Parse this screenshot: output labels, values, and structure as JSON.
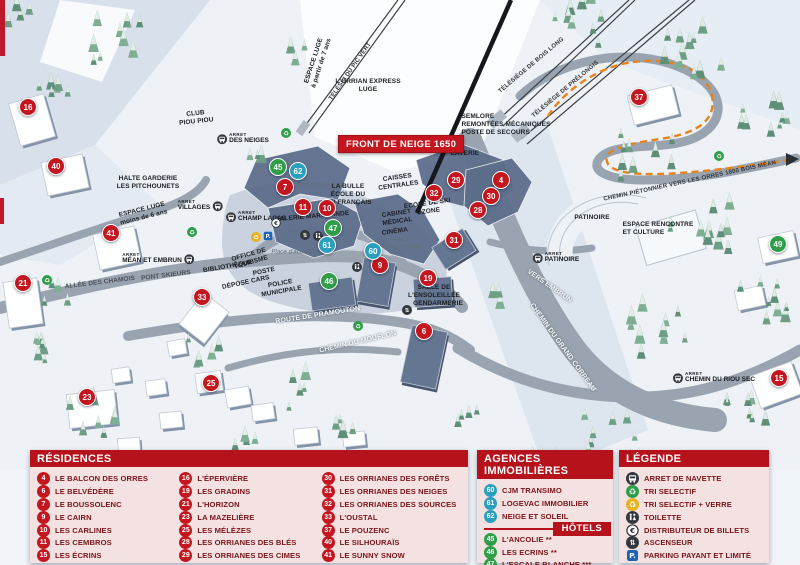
{
  "banner": "FRONT DE NEIGE 1650",
  "arret_prefix": "ARRET",
  "colors": {
    "marker_red": "#c4161f",
    "marker_green": "#2f9e49",
    "marker_blue": "#2b9fbe",
    "header_red": "#b5121b",
    "panel_bg": "#f4e2e2",
    "label_maroon": "#7a1419",
    "parking_blue": "#1f63b5",
    "recycle_green": "#2f9e49",
    "recycle_yellow": "#e9b320",
    "path_orange": "#e8831c"
  },
  "map": {
    "markers": [
      {
        "n": "16",
        "x": 28,
        "y": 107,
        "c": "red"
      },
      {
        "n": "40",
        "x": 56,
        "y": 166,
        "c": "red"
      },
      {
        "n": "41",
        "x": 111,
        "y": 233,
        "c": "red"
      },
      {
        "n": "21",
        "x": 23,
        "y": 283,
        "c": "red"
      },
      {
        "n": "33",
        "x": 202,
        "y": 297,
        "c": "red"
      },
      {
        "n": "23",
        "x": 87,
        "y": 397,
        "c": "red"
      },
      {
        "n": "25",
        "x": 211,
        "y": 383,
        "c": "red"
      },
      {
        "n": "7",
        "x": 285,
        "y": 187,
        "c": "red"
      },
      {
        "n": "11",
        "x": 303,
        "y": 207,
        "c": "red"
      },
      {
        "n": "10",
        "x": 327,
        "y": 208,
        "c": "red"
      },
      {
        "n": "9",
        "x": 380,
        "y": 265,
        "c": "red"
      },
      {
        "n": "19",
        "x": 428,
        "y": 278,
        "c": "red"
      },
      {
        "n": "6",
        "x": 424,
        "y": 331,
        "c": "red"
      },
      {
        "n": "29",
        "x": 456,
        "y": 180,
        "c": "red"
      },
      {
        "n": "32",
        "x": 434,
        "y": 193,
        "c": "red"
      },
      {
        "n": "4",
        "x": 501,
        "y": 180,
        "c": "red"
      },
      {
        "n": "30",
        "x": 491,
        "y": 196,
        "c": "red"
      },
      {
        "n": "28",
        "x": 478,
        "y": 210,
        "c": "red"
      },
      {
        "n": "31",
        "x": 454,
        "y": 240,
        "c": "red"
      },
      {
        "n": "37",
        "x": 639,
        "y": 97,
        "c": "red"
      },
      {
        "n": "15",
        "x": 779,
        "y": 378,
        "c": "red"
      },
      {
        "n": "45",
        "x": 278,
        "y": 167,
        "c": "green"
      },
      {
        "n": "47",
        "x": 333,
        "y": 228,
        "c": "green"
      },
      {
        "n": "46",
        "x": 329,
        "y": 281,
        "c": "green"
      },
      {
        "n": "49",
        "x": 778,
        "y": 244,
        "c": "green"
      },
      {
        "n": "62",
        "x": 298,
        "y": 171,
        "c": "blue"
      },
      {
        "n": "61",
        "x": 327,
        "y": 245,
        "c": "blue"
      },
      {
        "n": "60",
        "x": 373,
        "y": 251,
        "c": "blue"
      }
    ],
    "labels": [
      {
        "t": "ESPACE LUGE\nà partir de 7 ans",
        "x": 318,
        "y": 62,
        "r": -72,
        "s": "place"
      },
      {
        "t": "TÉLÉSKI DU PIC VERT",
        "x": 351,
        "y": 72,
        "r": -55,
        "s": "lift"
      },
      {
        "t": "TÉLÉSIÈGE DE BOIS LONG",
        "x": 532,
        "y": 66,
        "r": -40,
        "s": "lift"
      },
      {
        "t": "TÉLÉSIÈGE DE PRÉLONGIS",
        "x": 566,
        "y": 90,
        "r": -40,
        "s": "lift"
      },
      {
        "t": "L'ORRIAN EXPRESS\nLUGE",
        "x": 368,
        "y": 86,
        "r": 0,
        "s": "place"
      },
      {
        "t": "SEMLORE\nREMONTÉES MÉCANIQUES\nPOSTE DE SECOURS",
        "x": 506,
        "y": 125,
        "r": 0,
        "s": "place left"
      },
      {
        "t": "CHEMIN PIÉTONNIER\nVERS LES ORRES 1800\nBOIS MÉAN",
        "x": 690,
        "y": 182,
        "r": -12,
        "s": "lift left"
      },
      {
        "t": "CLUB\nPIOU PIOU",
        "x": 196,
        "y": 118,
        "r": -6,
        "s": "place"
      },
      {
        "t": "HALTE GARDERIE\nLES PITCHOUNETS",
        "x": 148,
        "y": 183,
        "r": 0,
        "s": "place"
      },
      {
        "t": "ESPACE LUGE\nmoins de 6 ans",
        "x": 143,
        "y": 214,
        "r": -14,
        "s": "place"
      },
      {
        "t": "OFFICE DE\nTOURISME",
        "x": 250,
        "y": 259,
        "r": -16,
        "s": "place"
      },
      {
        "t": "BIBLIOTHÈQUE",
        "x": 228,
        "y": 267,
        "r": -10,
        "s": "place"
      },
      {
        "t": "POSTE",
        "x": 264,
        "y": 272,
        "r": -12,
        "s": "place"
      },
      {
        "t": "DÉPOSE CARS",
        "x": 246,
        "y": 283,
        "r": -12,
        "s": "place"
      },
      {
        "t": "POLICE\nMUNICIPALE",
        "x": 281,
        "y": 288,
        "r": -10,
        "s": "place"
      },
      {
        "t": "ALLÉE DES CHAMOIS",
        "x": 100,
        "y": 283,
        "r": -7,
        "s": "road-dark"
      },
      {
        "t": "PONT SKIEURS",
        "x": 166,
        "y": 276,
        "r": -7,
        "s": "road-dark"
      },
      {
        "t": "Place d'accueil",
        "x": 292,
        "y": 253,
        "r": 0,
        "s": "it"
      },
      {
        "t": "Place du festival",
        "x": 320,
        "y": 186,
        "r": 0,
        "s": "it"
      },
      {
        "t": "Place\nÉmile Hodoul",
        "x": 402,
        "y": 245,
        "r": 0,
        "s": "it"
      },
      {
        "t": "LA BULLE\nÉCOLE DU\nSKI FRANÇAIS",
        "x": 348,
        "y": 195,
        "r": 0,
        "s": "place"
      },
      {
        "t": "GALERIE MARCHANDE",
        "x": 312,
        "y": 217,
        "r": -5,
        "s": "place"
      },
      {
        "t": "CAISSES\nCENTRALES",
        "x": 398,
        "y": 182,
        "r": -8,
        "s": "place"
      },
      {
        "t": "CABINET\nMÉDICAL",
        "x": 397,
        "y": 218,
        "r": -8,
        "s": "place"
      },
      {
        "t": "CINÉMA",
        "x": 395,
        "y": 232,
        "r": -8,
        "s": "place"
      },
      {
        "t": "ÉCOLE DE SKI\nOZONE",
        "x": 428,
        "y": 208,
        "r": -8,
        "s": "place"
      },
      {
        "t": "LAVERIE",
        "x": 465,
        "y": 154,
        "r": 0,
        "s": "place"
      },
      {
        "t": "SALLE DE\nL'ENSOLEILLÉE",
        "x": 434,
        "y": 292,
        "r": 0,
        "s": "place"
      },
      {
        "t": "GENDARMERIE",
        "x": 438,
        "y": 304,
        "r": 0,
        "s": "place"
      },
      {
        "t": "PATINOIRE",
        "x": 592,
        "y": 218,
        "r": 0,
        "s": "place"
      },
      {
        "t": "ESPACE RENCONTRE\nET CULTURE",
        "x": 658,
        "y": 229,
        "r": 0,
        "s": "place left"
      },
      {
        "t": "ROUTE DE PRAMOUTON",
        "x": 318,
        "y": 316,
        "r": -9,
        "s": "road-white"
      },
      {
        "t": "CHEMIN DU MOUFLON",
        "x": 358,
        "y": 343,
        "r": -13,
        "s": "road-white"
      },
      {
        "t": "CHEMIN DU GRAND CORREAU",
        "x": 562,
        "y": 348,
        "r": 54,
        "s": "road-white"
      },
      {
        "t": "VERS EMBRUN",
        "x": 549,
        "y": 287,
        "r": 35,
        "s": "road-white"
      }
    ],
    "bus_stops": [
      {
        "t": "DES NEIGES",
        "x": 243,
        "y": 139,
        "side": "l"
      },
      {
        "t": "VILLAGES",
        "x": 200,
        "y": 206,
        "side": "r"
      },
      {
        "t": "CHAMP LACAS",
        "x": 256,
        "y": 217,
        "side": "l"
      },
      {
        "t": "MÉAN ET EMBRUN",
        "x": 158,
        "y": 259,
        "side": "r"
      },
      {
        "t": "PATINOIRE",
        "x": 556,
        "y": 258,
        "side": "l"
      },
      {
        "t": "CHEMIN DU RIOU SEC",
        "x": 714,
        "y": 378,
        "side": "l"
      }
    ],
    "icons": [
      {
        "k": "recycle-green",
        "x": 286,
        "y": 133
      },
      {
        "k": "recycle-green",
        "x": 192,
        "y": 232
      },
      {
        "k": "recycle-green",
        "x": 47,
        "y": 280
      },
      {
        "k": "recycle-green",
        "x": 358,
        "y": 326
      },
      {
        "k": "recycle-green",
        "x": 719,
        "y": 156
      },
      {
        "k": "recycle-yellow",
        "x": 256,
        "y": 237
      },
      {
        "k": "parking",
        "x": 268,
        "y": 236
      },
      {
        "k": "euro",
        "x": 276,
        "y": 223
      },
      {
        "k": "elevator",
        "x": 305,
        "y": 235
      },
      {
        "k": "wc",
        "x": 318,
        "y": 236
      },
      {
        "k": "wc",
        "x": 357,
        "y": 267
      },
      {
        "k": "elevator",
        "x": 407,
        "y": 310
      }
    ]
  },
  "panels": {
    "residences": {
      "title": "RÉSIDENCES",
      "columns": [
        [
          {
            "n": "4",
            "label": "LE BALCON DES ORRES"
          },
          {
            "n": "6",
            "label": "LE BELVÉDÈRE"
          },
          {
            "n": "7",
            "label": "LE BOUSSOLENC"
          },
          {
            "n": "9",
            "label": "LE CAIRN"
          },
          {
            "n": "10",
            "label": "LES CARLINES"
          },
          {
            "n": "11",
            "label": "LES CEMBROS"
          },
          {
            "n": "15",
            "label": "LES ÉCRINS"
          }
        ],
        [
          {
            "n": "16",
            "label": "L'ÉPERVIÈRE"
          },
          {
            "n": "19",
            "label": "LES GRADINS"
          },
          {
            "n": "21",
            "label": "L'HORIZON"
          },
          {
            "n": "23",
            "label": "LA MAZELIÈRE"
          },
          {
            "n": "25",
            "label": "LES MÉLÈZES"
          },
          {
            "n": "28",
            "label": "LES ORRIANES DES BLÉS"
          },
          {
            "n": "29",
            "label": "LES ORRIANES DES CIMES"
          }
        ],
        [
          {
            "n": "30",
            "label": "LES ORRIANES DES FORÊTS"
          },
          {
            "n": "31",
            "label": "LES ORRIANES DES NEIGES"
          },
          {
            "n": "32",
            "label": "LES ORRIANES DES SOURCES"
          },
          {
            "n": "33",
            "label": "L'OUSTAL"
          },
          {
            "n": "37",
            "label": "LE POUZENC"
          },
          {
            "n": "40",
            "label": "LE SILHOURAÏS"
          },
          {
            "n": "41",
            "label": "LE SUNNY SNOW"
          }
        ]
      ]
    },
    "agences": {
      "title": "AGENCES IMMOBILIÈRES",
      "items": [
        {
          "n": "60",
          "label": "CJM TRANSIMO"
        },
        {
          "n": "61",
          "label": "LOGEVAC IMMOBILIER"
        },
        {
          "n": "62",
          "label": "NEIGE ET SOLEIL"
        }
      ],
      "hotels_title": "HÔTELS",
      "hotels": [
        {
          "n": "45",
          "label": "L'ANCOLIE **"
        },
        {
          "n": "46",
          "label": "LES ECRINS **"
        },
        {
          "n": "47",
          "label": "L'ESCALE BLANCHE ***"
        },
        {
          "n": "49",
          "label": "LES TRAPPEURS **"
        }
      ]
    },
    "legende": {
      "title": "LÉGENDE",
      "items": [
        {
          "icon": "bus",
          "label": "ARRET DE NAVETTE"
        },
        {
          "icon": "recycle-green",
          "label": "TRI SELECTIF"
        },
        {
          "icon": "recycle-yellow",
          "label": "TRI SELECTIF + VERRE"
        },
        {
          "icon": "wc",
          "label": "TOILETTE"
        },
        {
          "icon": "euro",
          "label": "DISTRIBUTEUR DE BILLETS"
        },
        {
          "icon": "elevator",
          "label": "ASCENSEUR"
        },
        {
          "icon": "parking",
          "label": "PARKING PAYANT ET LIMITÉ"
        }
      ]
    }
  }
}
